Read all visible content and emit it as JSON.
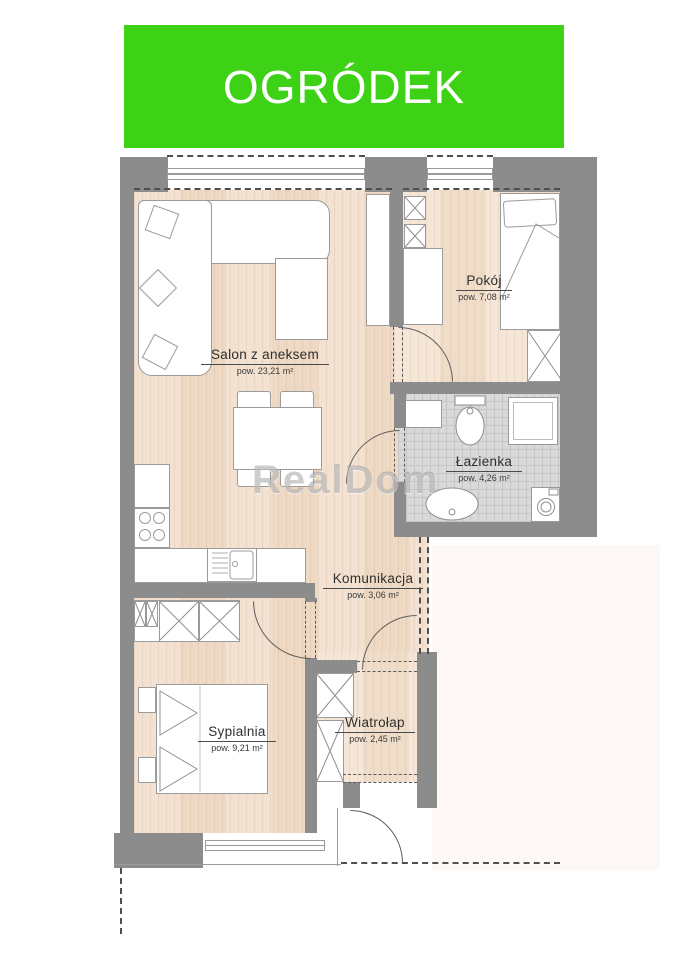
{
  "banner": {
    "label": "OGRÓDEK",
    "bg_color": "#3dd216",
    "text_color": "#ffffff"
  },
  "watermark": {
    "label": "RealDom"
  },
  "rooms": {
    "salon": {
      "name": "Salon z aneksem",
      "area": "pow. 23,21 m²"
    },
    "pokoj": {
      "name": "Pokój",
      "area": "pow. 7,08 m²"
    },
    "lazienka": {
      "name": "Łazienka",
      "area": "pow. 4,26 m²"
    },
    "komunikacja": {
      "name": "Komunikacja",
      "area": "pow. 3,06 m²"
    },
    "sypialnia": {
      "name": "Sypialnia",
      "area": "pow. 9,21 m²"
    },
    "wiatrolap": {
      "name": "Wiatrołap",
      "area": "pow. 2,45 m²"
    }
  },
  "colors": {
    "wall_gray": "#8c8c8c",
    "wood_light": "#f3e2d1",
    "wood_dark": "#eed9c4",
    "tile_gray": "#d9d9d9",
    "banner_green": "#3dd216"
  }
}
